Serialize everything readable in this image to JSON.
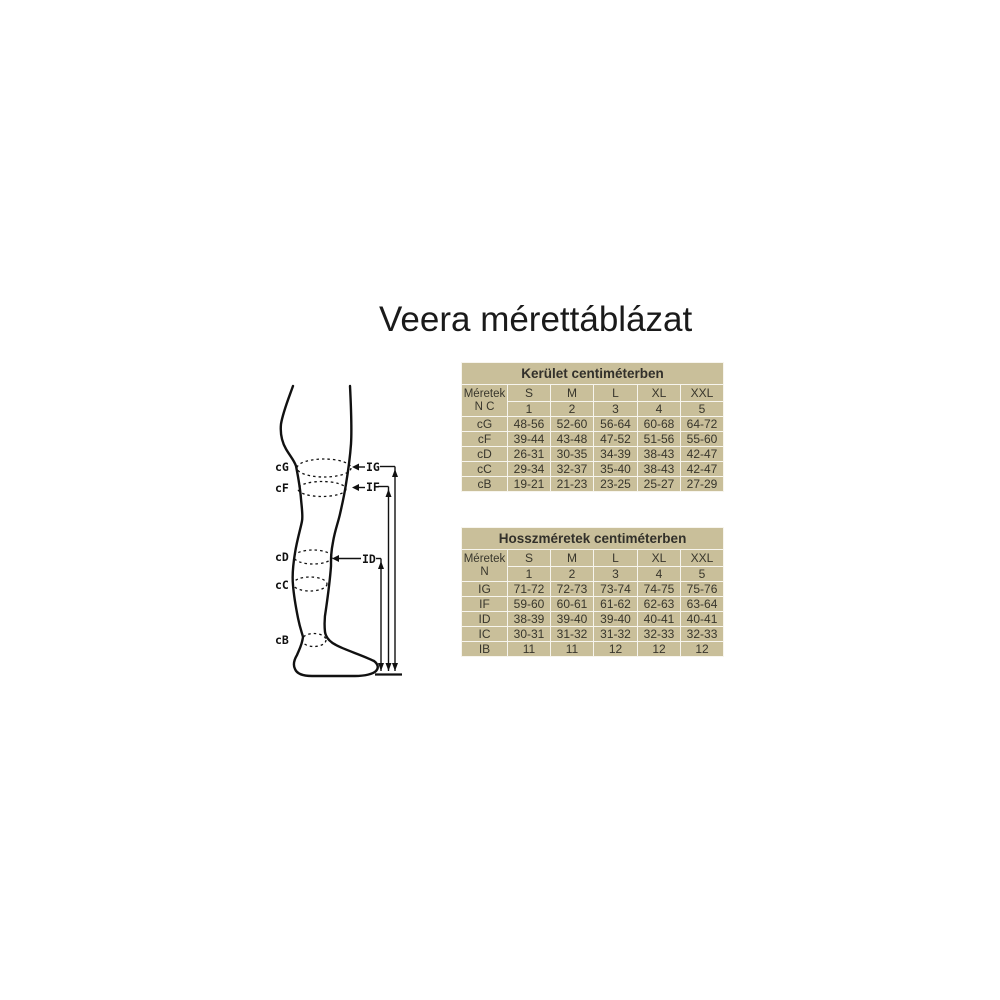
{
  "page": {
    "title": "Veera mérettáblázat"
  },
  "colors": {
    "background": "#ffffff",
    "table_cell_bg": "#c9bf9a",
    "table_grid": "#f7f5ee",
    "table_text": "#38362c",
    "diagram_ink": "#111111"
  },
  "diagram": {
    "labels": {
      "cG": "cG",
      "cF": "cF",
      "cD": "cD",
      "cC": "cC",
      "cB": "cB",
      "IG": "IG",
      "IF": "IF",
      "ID": "ID"
    }
  },
  "tables": [
    {
      "title": "Kerület centiméterben",
      "corner": {
        "line1": "Méretek",
        "line2": "N C"
      },
      "size_headers": [
        "S",
        "M",
        "L",
        "XL",
        "XXL"
      ],
      "number_headers": [
        "1",
        "2",
        "3",
        "4",
        "5"
      ],
      "rows": [
        {
          "label": "cG",
          "values": [
            "48-56",
            "52-60",
            "56-64",
            "60-68",
            "64-72"
          ]
        },
        {
          "label": "cF",
          "values": [
            "39-44",
            "43-48",
            "47-52",
            "51-56",
            "55-60"
          ]
        },
        {
          "label": "cD",
          "values": [
            "26-31",
            "30-35",
            "34-39",
            "38-43",
            "42-47"
          ]
        },
        {
          "label": "cC",
          "values": [
            "29-34",
            "32-37",
            "35-40",
            "38-43",
            "42-47"
          ]
        },
        {
          "label": "cB",
          "values": [
            "19-21",
            "21-23",
            "23-25",
            "25-27",
            "27-29"
          ]
        }
      ]
    },
    {
      "title": "Hosszméretek centiméterben",
      "corner": {
        "line1": "Méretek",
        "line2": "N"
      },
      "size_headers": [
        "S",
        "M",
        "L",
        "XL",
        "XXL"
      ],
      "number_headers": [
        "1",
        "2",
        "3",
        "4",
        "5"
      ],
      "rows": [
        {
          "label": "IG",
          "values": [
            "71-72",
            "72-73",
            "73-74",
            "74-75",
            "75-76"
          ]
        },
        {
          "label": "IF",
          "values": [
            "59-60",
            "60-61",
            "61-62",
            "62-63",
            "63-64"
          ]
        },
        {
          "label": "ID",
          "values": [
            "38-39",
            "39-40",
            "39-40",
            "40-41",
            "40-41"
          ]
        },
        {
          "label": "IC",
          "values": [
            "30-31",
            "31-32",
            "31-32",
            "32-33",
            "32-33"
          ]
        },
        {
          "label": "IB",
          "values": [
            "11",
            "11",
            "12",
            "12",
            "12"
          ]
        }
      ]
    }
  ]
}
